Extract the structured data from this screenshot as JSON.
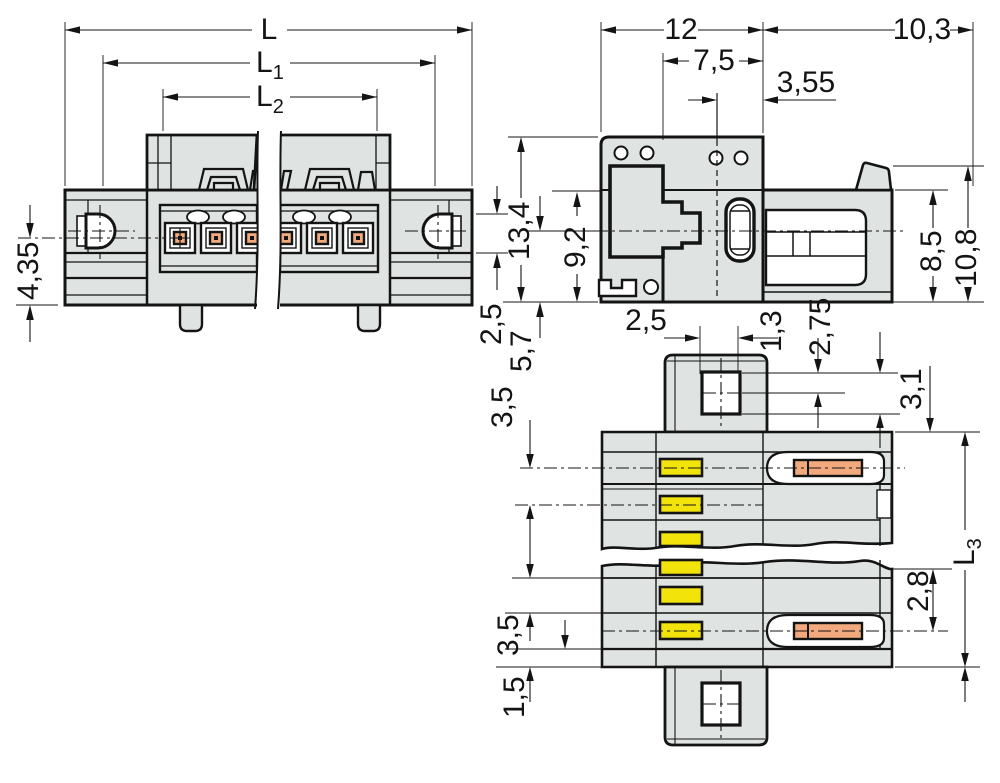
{
  "drawing": {
    "type": "technical-dimension-drawing",
    "colors": {
      "background": "#ffffff",
      "line": "#141414",
      "body_fill": "#dfe3e2",
      "cavity_fill": "#ffffff",
      "actuator_yellow": "#f2e30b",
      "contact_orange": "#f1a97d"
    },
    "views": {
      "front": {
        "label": "front view",
        "dims": {
          "overall_length": {
            "main": "L"
          },
          "length_1": {
            "main": "L",
            "sub": "1"
          },
          "length_2": {
            "main": "L",
            "sub": "2"
          },
          "height_below_axis": "4,35",
          "flange_offset": "2,5"
        }
      },
      "side": {
        "label": "side view",
        "dims": {
          "housing_width": "12",
          "pin_length": "10,3",
          "hole_offset": "7,5",
          "face_offset": "3,55",
          "total_height": "13,4",
          "plug_height": "9,2",
          "axis_height": "5,7",
          "right_height": "8,5",
          "right_total_height": "10,8"
        }
      },
      "top": {
        "label": "top view",
        "dims": {
          "boss_offset": "2,5",
          "hole_top": "1,3",
          "hole_bottom": "2,75",
          "edge_offset": "3,1",
          "pitch_top": "3,5",
          "length_3": {
            "main": "L",
            "sub": "3"
          },
          "row_offset": "2,8",
          "pitch_bottom": "3,5",
          "foot_offset": "1,5"
        }
      }
    }
  }
}
